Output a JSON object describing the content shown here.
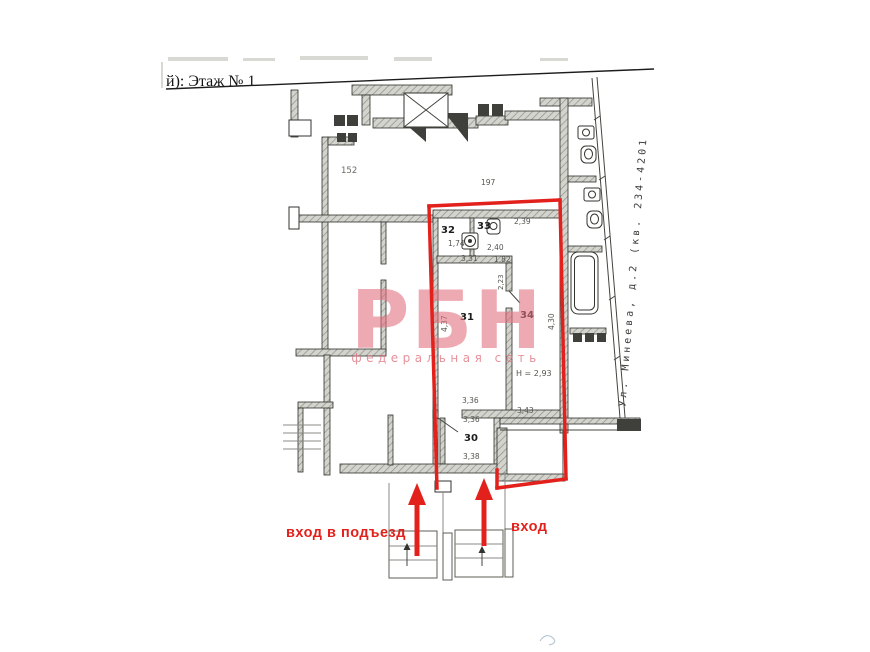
{
  "colors": {
    "red": "#e3211c",
    "pink": "#e2717e",
    "ink": "#141414"
  },
  "header": {
    "floor_label": "й): Этаж № 1"
  },
  "street": {
    "label": "Ул. Минеева, д.2 (кв. 234-4201"
  },
  "watermark": {
    "logo": "РБН",
    "subtitle": "федеральная сеть"
  },
  "labels": {
    "entrance_building": "вход в подъезд",
    "entrance": "вход"
  },
  "rooms": {
    "r30": {
      "number": "30",
      "dim_top": "3,36",
      "dim_bottom": "3,38"
    },
    "r31": {
      "number": "31",
      "dim_side": "4,37"
    },
    "r32": {
      "number": "32",
      "dim": "1,74"
    },
    "r33": {
      "number": "33",
      "dim": "2,40"
    },
    "r34": {
      "number": "34",
      "dim_top": "2,39",
      "dim_side": "4,30",
      "height": "Н = 2,93"
    },
    "loggia": {
      "dim": "3,43"
    }
  },
  "dims": {
    "hall_w": "3,31",
    "hall_n": "1,82",
    "corridor": "3,36",
    "d152": "152",
    "d197": "197",
    "d223": "2,23"
  }
}
